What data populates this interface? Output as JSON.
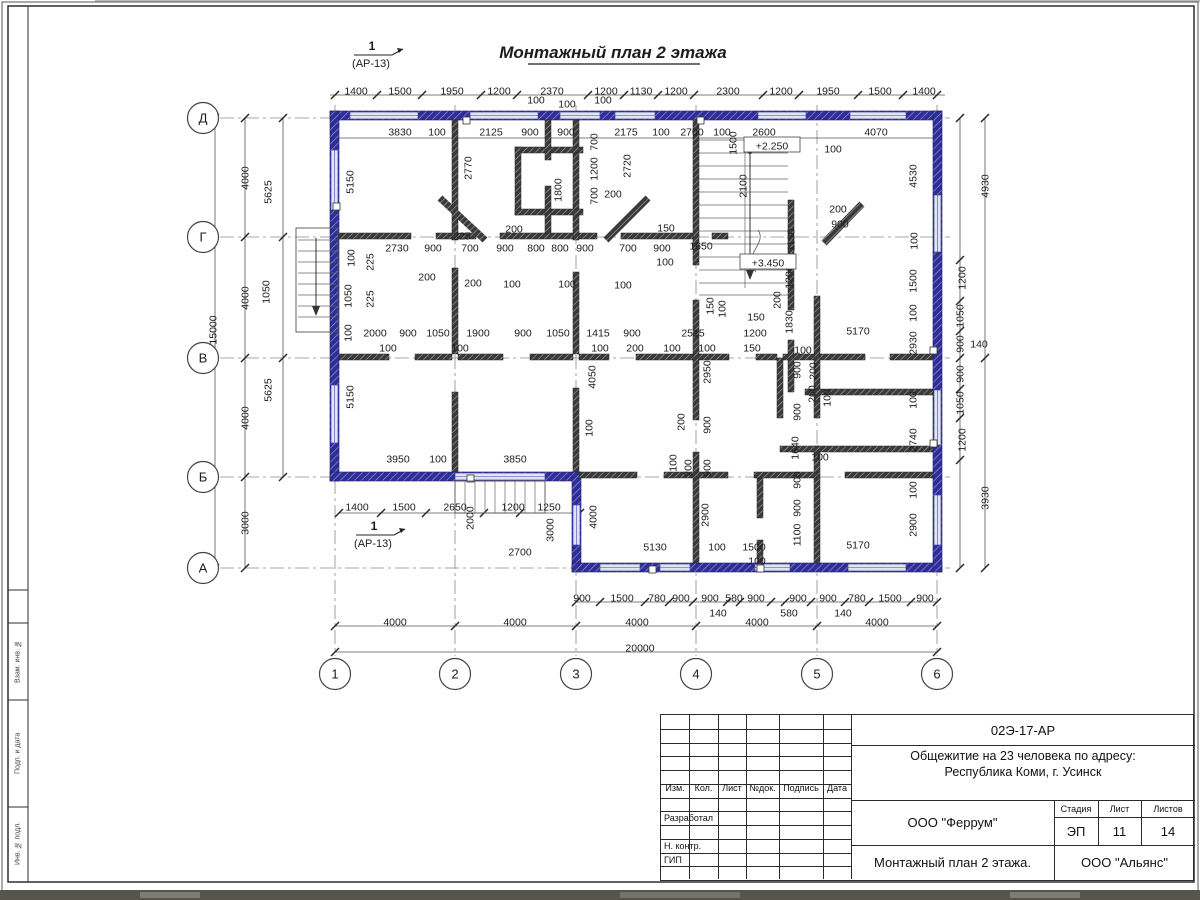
{
  "drawing": {
    "title": "Монтажный план 2 этажа",
    "section_mark": {
      "num": "1",
      "ref": "(АР-13)"
    },
    "axes_cols": [
      "1",
      "2",
      "3",
      "4",
      "5",
      "6"
    ],
    "axes_rows": [
      "Д",
      "Г",
      "В",
      "Б",
      "А"
    ],
    "dims": [
      [
        "1400",
        356,
        91,
        0
      ],
      [
        "1500",
        400,
        91,
        0
      ],
      [
        "1950",
        452,
        91,
        0
      ],
      [
        "1200",
        499,
        91,
        0
      ],
      [
        "2370",
        552,
        91,
        0
      ],
      [
        "1200",
        606,
        91,
        0
      ],
      [
        "1130",
        641,
        91,
        0
      ],
      [
        "1200",
        676,
        91,
        0
      ],
      [
        "2300",
        728,
        91,
        0
      ],
      [
        "1200",
        781,
        91,
        0
      ],
      [
        "1950",
        828,
        91,
        0
      ],
      [
        "1500",
        880,
        91,
        0
      ],
      [
        "1400",
        924,
        91,
        0
      ],
      [
        "100",
        536,
        100,
        0
      ],
      [
        "100",
        567,
        104,
        0
      ],
      [
        "100",
        603,
        100,
        0
      ],
      [
        "3830",
        400,
        132,
        0
      ],
      [
        "100",
        437,
        132,
        0
      ],
      [
        "2125",
        491,
        132,
        0
      ],
      [
        "900",
        530,
        132,
        0
      ],
      [
        "900",
        566,
        132,
        0
      ],
      [
        "2175",
        626,
        132,
        0
      ],
      [
        "100",
        661,
        132,
        0
      ],
      [
        "2700",
        692,
        132,
        0
      ],
      [
        "100",
        722,
        132,
        0
      ],
      [
        "2600",
        764,
        132,
        0
      ],
      [
        "4070",
        876,
        132,
        0
      ],
      [
        "100",
        833,
        149,
        0
      ],
      [
        "1500",
        733,
        143,
        1
      ],
      [
        "2100",
        743,
        186,
        1
      ],
      [
        "1130",
        791,
        240,
        1
      ],
      [
        "200",
        838,
        209,
        0
      ],
      [
        "900",
        840,
        224,
        0
      ],
      [
        "5150",
        350,
        182,
        1
      ],
      [
        "5150",
        350,
        397,
        1
      ],
      [
        "2770",
        468,
        168,
        1
      ],
      [
        "1800",
        558,
        190,
        1
      ],
      [
        "700",
        594,
        142,
        1
      ],
      [
        "1200",
        594,
        169,
        1
      ],
      [
        "700",
        594,
        196,
        1
      ],
      [
        "2720",
        627,
        166,
        1
      ],
      [
        "200",
        613,
        194,
        0
      ],
      [
        "4530",
        913,
        176,
        1
      ],
      [
        "4930",
        985,
        186,
        1
      ],
      [
        "2730",
        397,
        248,
        0
      ],
      [
        "900",
        433,
        248,
        0
      ],
      [
        "700",
        470,
        248,
        0
      ],
      [
        "900",
        505,
        248,
        0
      ],
      [
        "800",
        536,
        248,
        0
      ],
      [
        "800",
        560,
        248,
        0
      ],
      [
        "900",
        585,
        248,
        0
      ],
      [
        "700",
        628,
        248,
        0
      ],
      [
        "900",
        662,
        248,
        0
      ],
      [
        "1650",
        701,
        246,
        0
      ],
      [
        "225",
        462,
        236,
        0
      ],
      [
        "200",
        514,
        229,
        0
      ],
      [
        "150",
        666,
        228,
        0
      ],
      [
        "200",
        427,
        277,
        0
      ],
      [
        "200",
        473,
        283,
        0
      ],
      [
        "100",
        512,
        284,
        0
      ],
      [
        "100",
        567,
        284,
        0
      ],
      [
        "100",
        623,
        285,
        0
      ],
      [
        "100",
        665,
        262,
        0
      ],
      [
        "100",
        351,
        258,
        1
      ],
      [
        "225",
        370,
        262,
        1
      ],
      [
        "1050",
        348,
        296,
        1
      ],
      [
        "225",
        370,
        299,
        1
      ],
      [
        "1200",
        789,
        277,
        1
      ],
      [
        "200",
        777,
        300,
        1
      ],
      [
        "150",
        756,
        317,
        0
      ],
      [
        "1830",
        789,
        322,
        1
      ],
      [
        "5170",
        858,
        331,
        0
      ],
      [
        "2930",
        913,
        343,
        1
      ],
      [
        "100",
        913,
        313,
        1
      ],
      [
        "1500",
        913,
        281,
        1
      ],
      [
        "100",
        914,
        241,
        1
      ],
      [
        "2000",
        375,
        333,
        0
      ],
      [
        "900",
        408,
        333,
        0
      ],
      [
        "1050",
        438,
        333,
        0
      ],
      [
        "1900",
        478,
        333,
        0
      ],
      [
        "900",
        523,
        333,
        0
      ],
      [
        "1050",
        558,
        333,
        0
      ],
      [
        "1415",
        598,
        333,
        0
      ],
      [
        "900",
        632,
        333,
        0
      ],
      [
        "2515",
        693,
        333,
        0
      ],
      [
        "1200",
        755,
        333,
        0
      ],
      [
        "100",
        388,
        348,
        0
      ],
      [
        "100",
        460,
        348,
        0
      ],
      [
        "100",
        600,
        348,
        0
      ],
      [
        "200",
        635,
        348,
        0
      ],
      [
        "100",
        672,
        348,
        0
      ],
      [
        "100",
        707,
        348,
        0
      ],
      [
        "150",
        752,
        348,
        0
      ],
      [
        "150",
        710,
        306,
        1
      ],
      [
        "100",
        722,
        309,
        1
      ],
      [
        "100",
        348,
        333,
        1
      ],
      [
        "4050",
        592,
        377,
        1
      ],
      [
        "2950",
        707,
        372,
        1
      ],
      [
        "900",
        707,
        425,
        1
      ],
      [
        "200",
        681,
        422,
        1
      ],
      [
        "100",
        589,
        428,
        1
      ],
      [
        "100",
        803,
        350,
        0
      ],
      [
        "900",
        797,
        370,
        1
      ],
      [
        "200",
        813,
        371,
        1
      ],
      [
        "900",
        797,
        412,
        1
      ],
      [
        "200",
        812,
        394,
        1
      ],
      [
        "100",
        827,
        398,
        1
      ],
      [
        "1640",
        795,
        448,
        1
      ],
      [
        "100",
        820,
        457,
        0
      ],
      [
        "2740",
        913,
        440,
        1
      ],
      [
        "100",
        913,
        490,
        1
      ],
      [
        "3950",
        398,
        459,
        0
      ],
      [
        "100",
        438,
        459,
        0
      ],
      [
        "3850",
        515,
        459,
        0
      ],
      [
        "100",
        673,
        463,
        1
      ],
      [
        "200",
        688,
        468,
        1
      ],
      [
        "900",
        707,
        468,
        1
      ],
      [
        "4000",
        593,
        517,
        1
      ],
      [
        "2900",
        705,
        515,
        1
      ],
      [
        "2900",
        913,
        525,
        1
      ],
      [
        "5170",
        858,
        545,
        0
      ],
      [
        "1100",
        797,
        535,
        1
      ],
      [
        "900",
        797,
        480,
        1
      ],
      [
        "900",
        797,
        508,
        1
      ],
      [
        "5130",
        655,
        547,
        0
      ],
      [
        "100",
        717,
        547,
        0
      ],
      [
        "1500",
        754,
        547,
        0
      ],
      [
        "100",
        757,
        561,
        0
      ],
      [
        "1400",
        357,
        507,
        0
      ],
      [
        "1500",
        404,
        507,
        0
      ],
      [
        "2650",
        455,
        507,
        0
      ],
      [
        "1200",
        513,
        507,
        0
      ],
      [
        "1250",
        549,
        507,
        0
      ],
      [
        "2000",
        470,
        518,
        1
      ],
      [
        "3000",
        550,
        530,
        1
      ],
      [
        "2700",
        520,
        552,
        0
      ],
      [
        "900",
        582,
        598,
        0
      ],
      [
        "1500",
        622,
        598,
        0
      ],
      [
        "780",
        657,
        598,
        0
      ],
      [
        "900",
        681,
        598,
        0
      ],
      [
        "900",
        710,
        598,
        0
      ],
      [
        "580",
        734,
        598,
        0
      ],
      [
        "900",
        756,
        598,
        0
      ],
      [
        "900",
        798,
        598,
        0
      ],
      [
        "900",
        828,
        598,
        0
      ],
      [
        "780",
        857,
        598,
        0
      ],
      [
        "1500",
        890,
        598,
        0
      ],
      [
        "900",
        925,
        598,
        0
      ],
      [
        "140",
        718,
        613,
        0
      ],
      [
        "580",
        789,
        613,
        0
      ],
      [
        "140",
        843,
        613,
        0
      ],
      [
        "4000",
        395,
        622,
        0
      ],
      [
        "4000",
        515,
        622,
        0
      ],
      [
        "4000",
        637,
        622,
        0
      ],
      [
        "4000",
        757,
        622,
        0
      ],
      [
        "4000",
        877,
        622,
        0
      ],
      [
        "20000",
        640,
        648,
        0
      ],
      [
        "15000",
        213,
        330,
        1
      ],
      [
        "4000",
        245,
        178,
        1
      ],
      [
        "4000",
        245,
        298,
        1
      ],
      [
        "4000",
        245,
        418,
        1
      ],
      [
        "3000",
        245,
        523,
        1
      ],
      [
        "5625",
        268,
        192,
        1
      ],
      [
        "5625",
        268,
        390,
        1
      ],
      [
        "1050",
        266,
        292,
        1
      ],
      [
        "1200",
        962,
        278,
        1
      ],
      [
        "1050",
        960,
        316,
        1
      ],
      [
        "900",
        960,
        344,
        1
      ],
      [
        "140",
        979,
        344,
        0
      ],
      [
        "900",
        960,
        374,
        1
      ],
      [
        "1050",
        960,
        403,
        1
      ],
      [
        "1200",
        962,
        440,
        1
      ],
      [
        "3930",
        985,
        498,
        1
      ],
      [
        "100",
        913,
        400,
        1
      ],
      [
        "+2.250",
        772,
        146,
        2
      ],
      [
        "+3.450",
        768,
        263,
        2
      ]
    ]
  },
  "frame_labels": [
    "Взам. инв. №",
    "Подп. и дата",
    "Инв. № подл."
  ],
  "title_block": {
    "doc_code": "02Э-17-АР",
    "project_line1": "Общежитие на 23 человека по адресу:",
    "project_line2": "Республика Коми, г. Усинск",
    "columns": [
      "Изм.",
      "Кол.",
      "Лист",
      "№док.",
      "Подпись",
      "Дата"
    ],
    "roles": [
      "Разработал",
      "Н. контр.",
      "ГИП"
    ],
    "org": "ООО \"Феррум\"",
    "stage_label": "Стадия",
    "sheet_label": "Лист",
    "sheets_label": "Листов",
    "stage": "ЭП",
    "sheet": "11",
    "sheets": "14",
    "sheet_title": "Монтажный план 2 этажа.",
    "org2": "ООО \"Альянс\""
  }
}
